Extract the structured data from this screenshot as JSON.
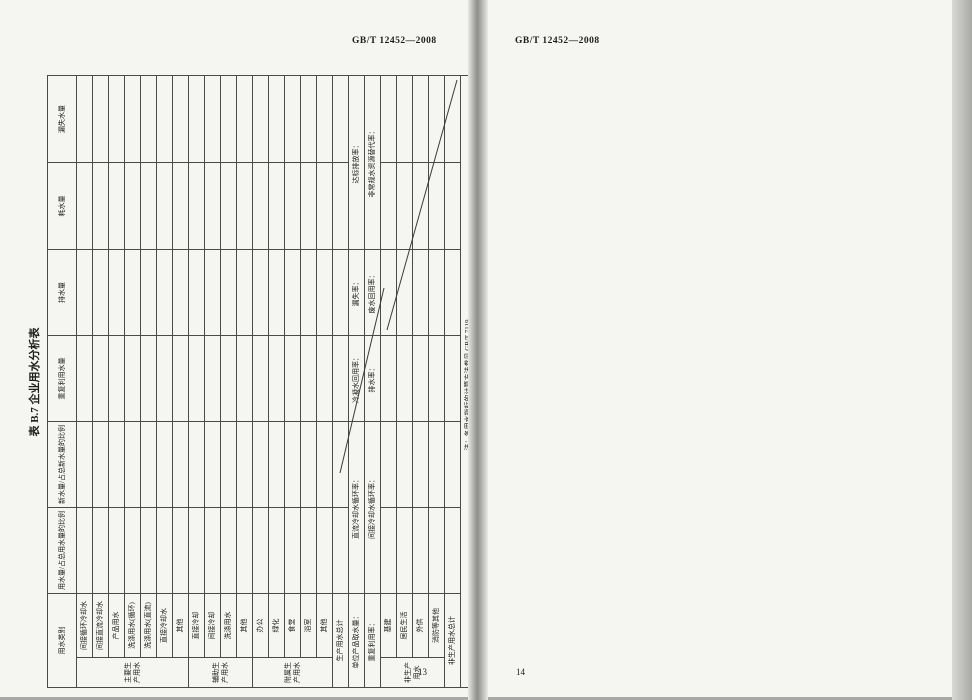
{
  "left_page": {
    "header": "GB/T 12452—2008",
    "page_number": "13",
    "table": {
      "title": "表 B.7  企业用水分析表",
      "headers": [
        "用水类别",
        "用水量/占总用水量的比例",
        "新水量/占总新水量的比例",
        "重复利用水量",
        "排水量",
        "耗水量",
        "漏失水量"
      ],
      "groups": [
        "主要生产用水",
        "辅助生产用水",
        "附属生产用水",
        "非生产用水"
      ],
      "rows_main": [
        "间接循环冷却水",
        "间接直流冷却水",
        "产品用水",
        "洗涤用水(循环)",
        "洗涤用水(直流)",
        "直接冷却水",
        "其他"
      ],
      "rows_aux": [
        "直接冷却",
        "间接冷却",
        "洗涤用水",
        "其他"
      ],
      "rows_attached": [
        "办公",
        "绿化",
        "食堂",
        "浴室",
        "其他"
      ],
      "total_production": "生产用水总计",
      "rate_row1": [
        "单位产品取水量：",
        "直流冷却水循环率：",
        "冷凝水回用率：",
        "漏失率：",
        "达标排放率："
      ],
      "rate_row2": [
        "重复利用率：",
        "间接冷却水循环率：",
        "排水率：",
        "废水回用率：",
        "非常规水资源替代率："
      ],
      "rows_nonprod": [
        "基建",
        "居民生活",
        "外供",
        "消防等其他"
      ],
      "total_nonproduction": "非生产用水总计",
      "note": "注：各用水指标的计算方法参见 GB/T 7119。"
    }
  },
  "right_page": {
    "header": "GB/T 12452—2008",
    "page_number": "14",
    "appendix": {
      "title_line1": "附　录　C",
      "title_line2": "（资料性附录）",
      "title_line3": "水平衡方框图示例",
      "intro": "水平衡方框图示例见图 C.1～图 C.4。"
    },
    "diagram": {
      "source_box": "水源取水泵站",
      "purchase_box": "外购水等其他",
      "treatment": [
        "净化水厂",
        "软化水处理站",
        "除盐水处理站",
        "生活水净化站"
      ],
      "main_system": "主要生产系统",
      "workshops": [
        "一车间",
        "二车间",
        "三车间",
        "四车间",
        "五车间",
        "六车间",
        "七车间",
        "八车间",
        "九车间",
        "串联水站"
      ],
      "aux_system": "辅助生产系统",
      "aux_units": [
        "锅炉房",
        "空压站",
        "制氧站",
        "鼓风机站"
      ],
      "sub_system": "附属生产系统",
      "other_box": "其他",
      "discharge_box": "外排",
      "out_arrow1": "外排",
      "out_arrow2": "外供",
      "loop_label": "Vcy",
      "line_labels": [
        "Vf",
        "Vs",
        "Vcy",
        "Vd-1",
        "Vf",
        "Vs-1",
        "Vs(1)",
        "Vd-1",
        "Vd-2",
        "Vs",
        "Vcy",
        "Vf"
      ],
      "legend": [
        {
          "sym": "—Vf—",
          "label": "新水"
        },
        {
          "sym": "—Vs—",
          "label": "回用水"
        },
        {
          "sym": "┄Vcy┄",
          "label": "循环水"
        },
        {
          "sym": "—Vs-1～Vs-n—",
          "label": "串级水"
        },
        {
          "sym": "—Vd-1—",
          "label": "生活污水"
        },
        {
          "sym": "—Vd-2—",
          "label": "生产排水"
        },
        {
          "sym": "—Vs(1)—",
          "label": "串联水(回用)"
        }
      ],
      "caption": "图 C.1  企业水平衡方框图示例"
    }
  }
}
